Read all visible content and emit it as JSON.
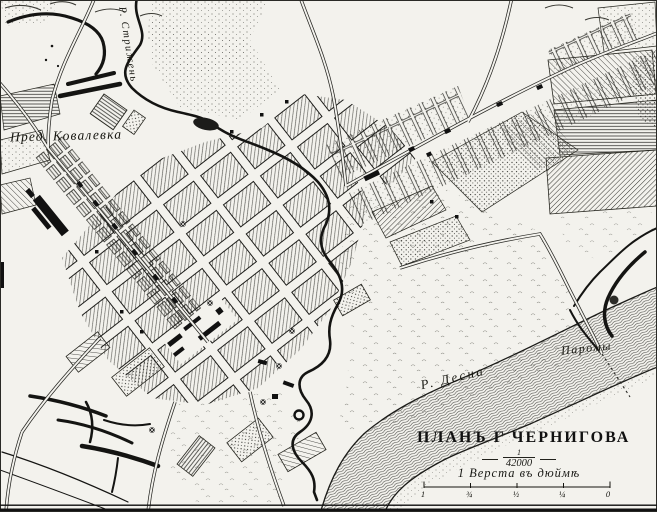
{
  "map": {
    "labels": {
      "suburb": "Пред. Ковалевка",
      "river_strizhen": "Р. Стрижень",
      "river_desna": "Р. Десна",
      "ferries": "Паромы"
    },
    "title_block": {
      "title": "ПЛАНЪ Г ЧЕРНИГОВА",
      "scale_numerator": "1",
      "scale_denominator": "42000",
      "scale_caption": "1 Верста въ дюймѣ",
      "bar_ticks": [
        "1",
        "¾",
        "½",
        "¼",
        "0"
      ]
    },
    "colors": {
      "ink": "#1a1a16",
      "paper": "#f3f2ed",
      "water_line": "#3f3f3b"
    }
  }
}
